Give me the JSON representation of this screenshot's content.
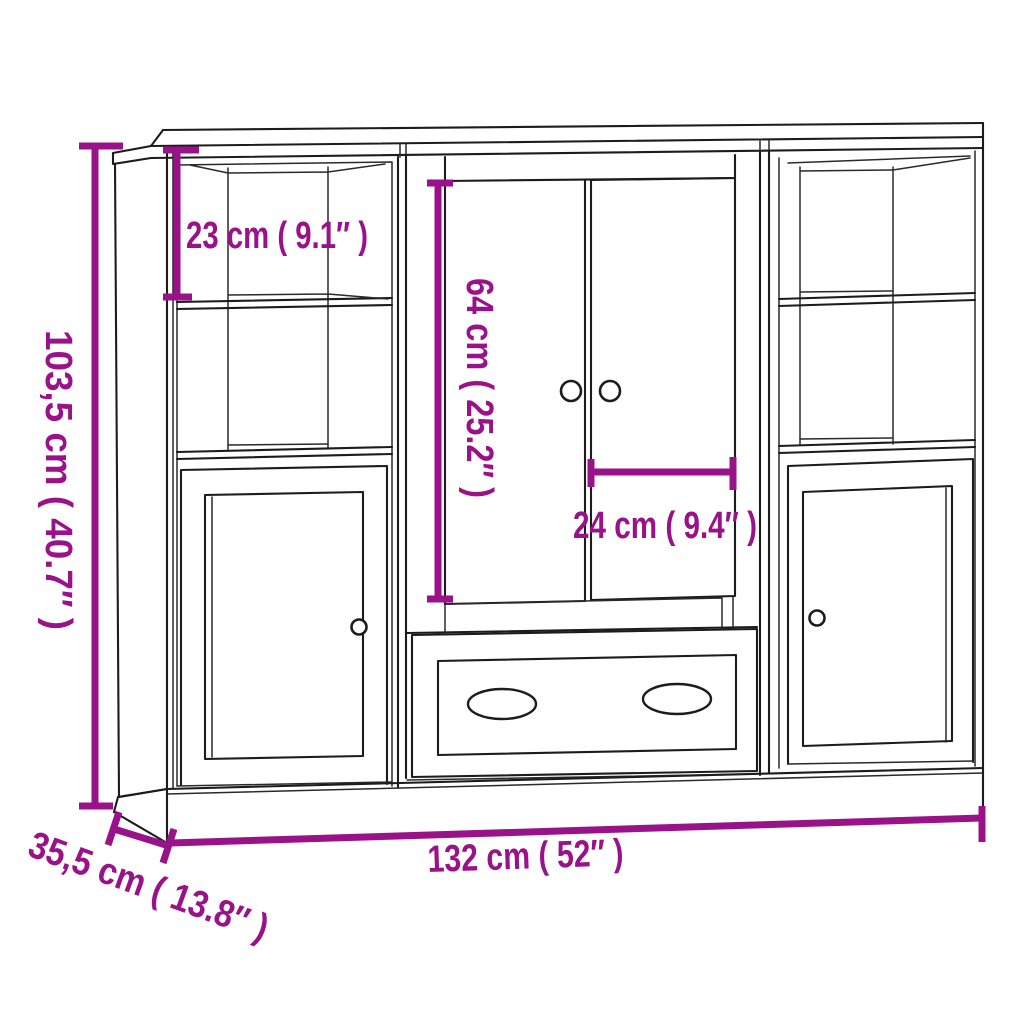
{
  "diagram": {
    "kind": "furniture-dimension-diagram",
    "colors": {
      "dimension_accent": "#9A1289",
      "outline": "#1C1C1C",
      "background": "#FFFFFF"
    },
    "labels": {
      "height": "103,5 cm ( 40.7″ )",
      "top_compartment_height": "23 cm ( 9.1″ )",
      "door_height": "64 cm ( 25.2″ )",
      "door_width": "24 cm ( 9.4″ )",
      "width": "132 cm ( 52″ )",
      "depth": "35,5 cm ( 13.8″ )"
    }
  }
}
